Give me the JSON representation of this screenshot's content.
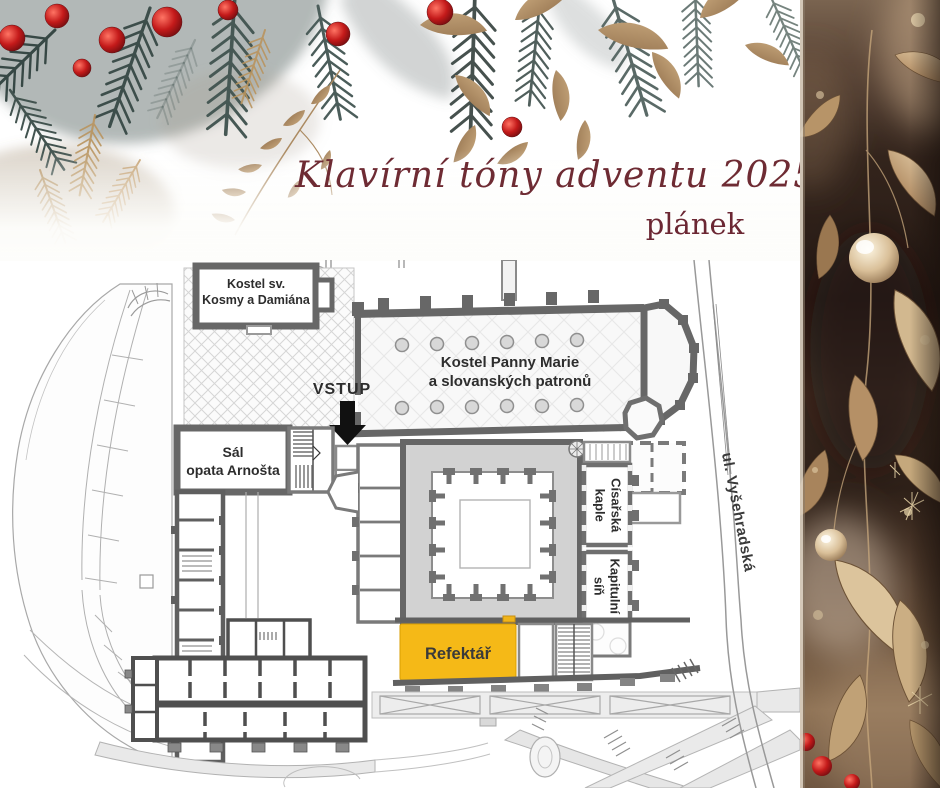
{
  "header": {
    "title": "Klavírní tóny adventu 2025",
    "subtitle": "plánek"
  },
  "plan": {
    "entrance_label": "VSTUP",
    "street_label": "ul. Vyšehradská",
    "rooms": {
      "kostel_kosmy": {
        "lines": [
          "Kostel sv.",
          "Kosmy a Damiána"
        ]
      },
      "kostel_marie": {
        "lines": [
          "Kostel Panny Marie",
          "a slovanských patronů"
        ]
      },
      "sal_opata": {
        "lines": [
          "Sál",
          "opata Arnošta"
        ]
      },
      "cisarska_kaple": {
        "lines": [
          "Císařská",
          "kaple"
        ]
      },
      "kapitulni_sin": {
        "lines": [
          "Kapitulní",
          "síň"
        ]
      },
      "refektar": {
        "label": "Refektář"
      }
    },
    "highlighted_room": "Refektář"
  },
  "colors": {
    "title_text": "#6e2b33",
    "plan_walls": "#676767",
    "cloister_fill": "#d2d2d2",
    "refektar_highlight": "#f5b917",
    "entrance_arrow": "#111111"
  },
  "decorations": {
    "top_banner": "pine-branches-red-berries-gold-leaves",
    "right_banner": "gold-leaves-pearls-on-dark-brown"
  }
}
